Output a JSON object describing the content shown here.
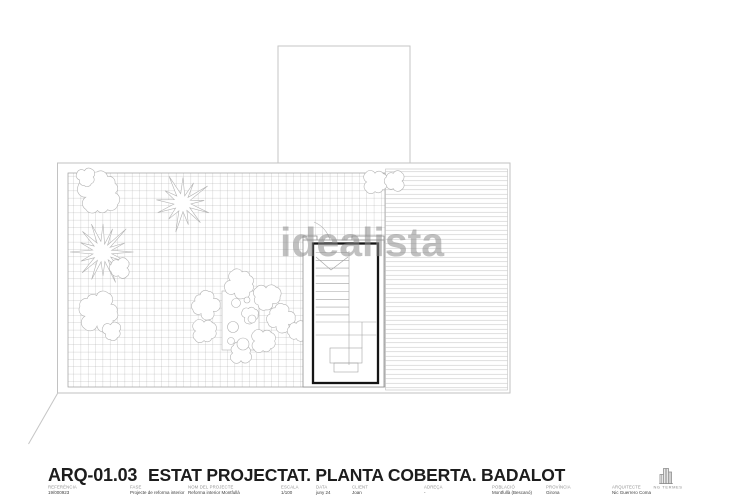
{
  "watermark": {
    "text": "idealista"
  },
  "title_block": {
    "drawing_code": "ARQ-01.03",
    "drawing_title": "ESTAT PROJECTAT. PLANTA COBERTA. BADALOT",
    "fields": [
      {
        "label": "REFERÈNCIA",
        "value": "19/000923"
      },
      {
        "label": "FASE",
        "value": "Projecte de reforma interior"
      },
      {
        "label": "NOM DEL PROJECTE",
        "value": "Reforma interior Montfullà"
      },
      {
        "label": "ESCALA",
        "value": "1/100"
      },
      {
        "label": "DATA",
        "value": "juny 24"
      },
      {
        "label": "CLIENT",
        "value": "Joan"
      },
      {
        "label": "ADREÇA",
        "value": "-"
      },
      {
        "label": "POBLACIÓ",
        "value": "Montfullà (Bescanó)"
      },
      {
        "label": "PROVÍNCIA",
        "value": "Girona"
      },
      {
        "label": "ARQUITECTE",
        "value": "Nic Guerrero Coma"
      }
    ],
    "logo_text": "NG TERMES",
    "logo_icon": "buildings-icon"
  },
  "colors": {
    "bold_line": "#151515",
    "light_line": "#c6c6c6",
    "grid_line": "#a8a8a8",
    "stripe_line": "#c9c9c9",
    "plant_line": "#b3b3b3",
    "watermark_gray": "#8c8c8c"
  }
}
